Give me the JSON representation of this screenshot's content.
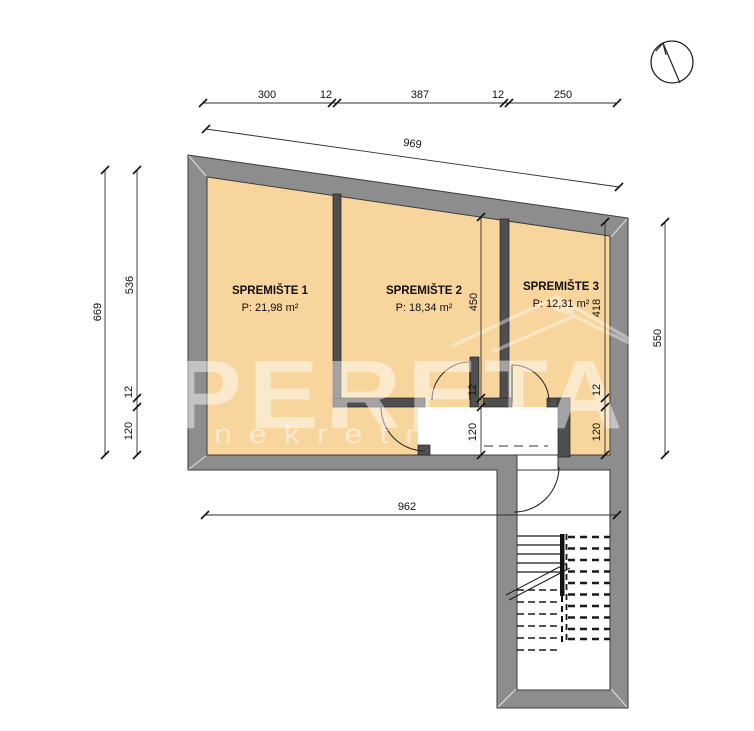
{
  "plan": {
    "rooms": [
      {
        "label": "SPREMIŠTE 1",
        "area": "P: 21,98 m²"
      },
      {
        "label": "SPREMIŠTE 2",
        "area": "P: 18,34 m²"
      },
      {
        "label": "SPREMIŠTE 3",
        "area": "P: 12,31 m²"
      }
    ]
  },
  "dimensions": {
    "top_chain": [
      "300",
      "12",
      "387",
      "12",
      "250"
    ],
    "top_total": "969",
    "left_total": "669",
    "left_chain": [
      "536",
      "12",
      "120"
    ],
    "room2_chain": [
      "450",
      "12",
      "120"
    ],
    "room3_chain": [
      "418",
      "12",
      "120"
    ],
    "right_total": "550",
    "bottom_total": "962"
  },
  "watermark": {
    "brand": "OPERETA",
    "subtitle": "nekretnine"
  },
  "colors": {
    "room_fill": "#f8d59c",
    "wall_gray": "#8d8d8d",
    "partition_gray": "#4f4f4f"
  }
}
